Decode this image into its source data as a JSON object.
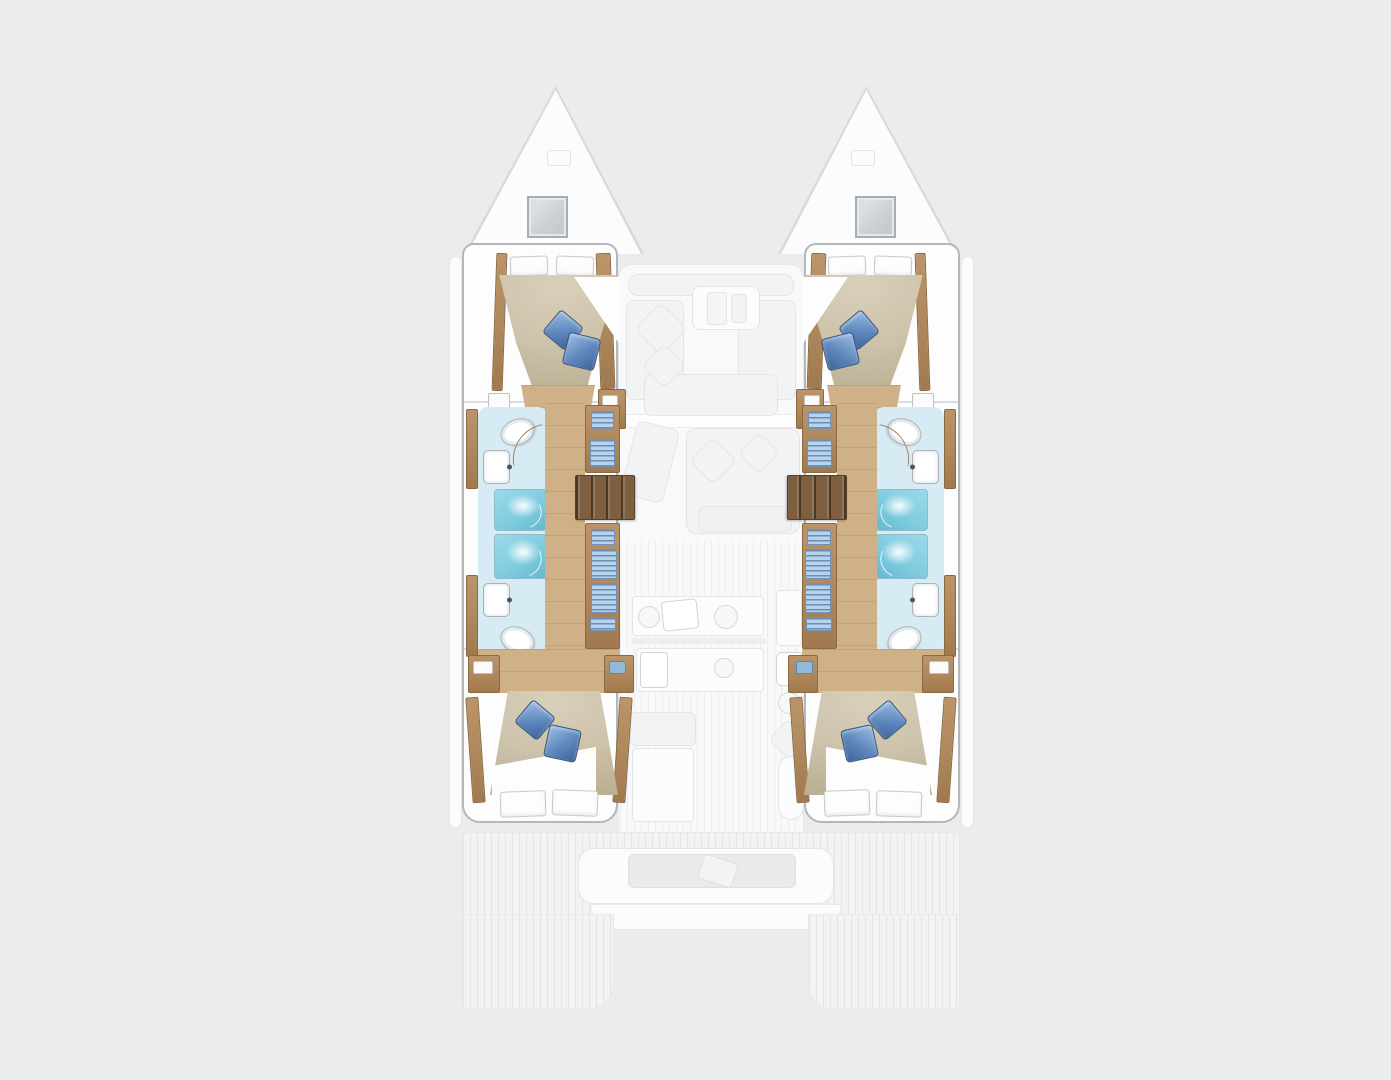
{
  "page": {
    "title": "Catamaran yacht interior layout — top-down floor plan, bow up"
  },
  "colors": {
    "background": "#ebeced",
    "hull_fill": "#fdfdfe",
    "hull_outline": "#b4b7ba",
    "wood": "#ae885b",
    "wood_dark": "#8a6a42",
    "wood_floor": "#d0b187",
    "steps_wood": "#7e5f3f",
    "duvet": "#cdc2aa",
    "pillow_blue": "#5d87bd",
    "pillow_blue_dark": "#35567e",
    "bath_floor": "#d7ebf4",
    "shower_blue": "#7ecadf",
    "fixture_outline": "#aeb2b5",
    "locker_blue": "#b7d2ec",
    "door_swing": "#a8855c",
    "ghost_fill": "#f2f3f5",
    "ghost_border": "#e3e5e7",
    "ghost_white": "#fbfcfd",
    "hatch_fill": "#ced1d3",
    "hatch_border": "#a9adaf"
  },
  "vessel": {
    "type": "catamaran",
    "orientation": "bow-up",
    "port_hull": {
      "forward_cabin": {
        "bed": "double",
        "white_pillows": 2,
        "blue_pillows": 2
      },
      "forward_bathroom": {
        "toilet": 1,
        "sink": 1,
        "shower": 1
      },
      "aft_bathroom": {
        "toilet": 1,
        "sink": 1,
        "shower": 1
      },
      "companionway_steps": 1,
      "inboard_lockers": 8,
      "aft_cabin": {
        "bed": "double",
        "white_pillows": 2,
        "blue_pillows": 2
      }
    },
    "starboard_hull": {
      "forward_cabin": {
        "bed": "double",
        "white_pillows": 2,
        "blue_pillows": 2
      },
      "forward_bathroom": {
        "toilet": 1,
        "sink": 1,
        "shower": 1
      },
      "aft_bathroom": {
        "toilet": 1,
        "sink": 1,
        "shower": 1
      },
      "companionway_steps": 1,
      "inboard_lockers": 8,
      "aft_cabin": {
        "bed": "double",
        "white_pillows": 2,
        "blue_pillows": 2
      }
    },
    "deck_ghosted": {
      "bow_hatches": 2,
      "forward_lounge": "U-sofa, cushions and table",
      "salon": "sofa, chaise and cushions",
      "galley": "counters, two sinks, burners",
      "salon_table": 1,
      "helm_seat": 1,
      "aft_cockpit": "bench seating",
      "swim_platforms": 2
    }
  }
}
